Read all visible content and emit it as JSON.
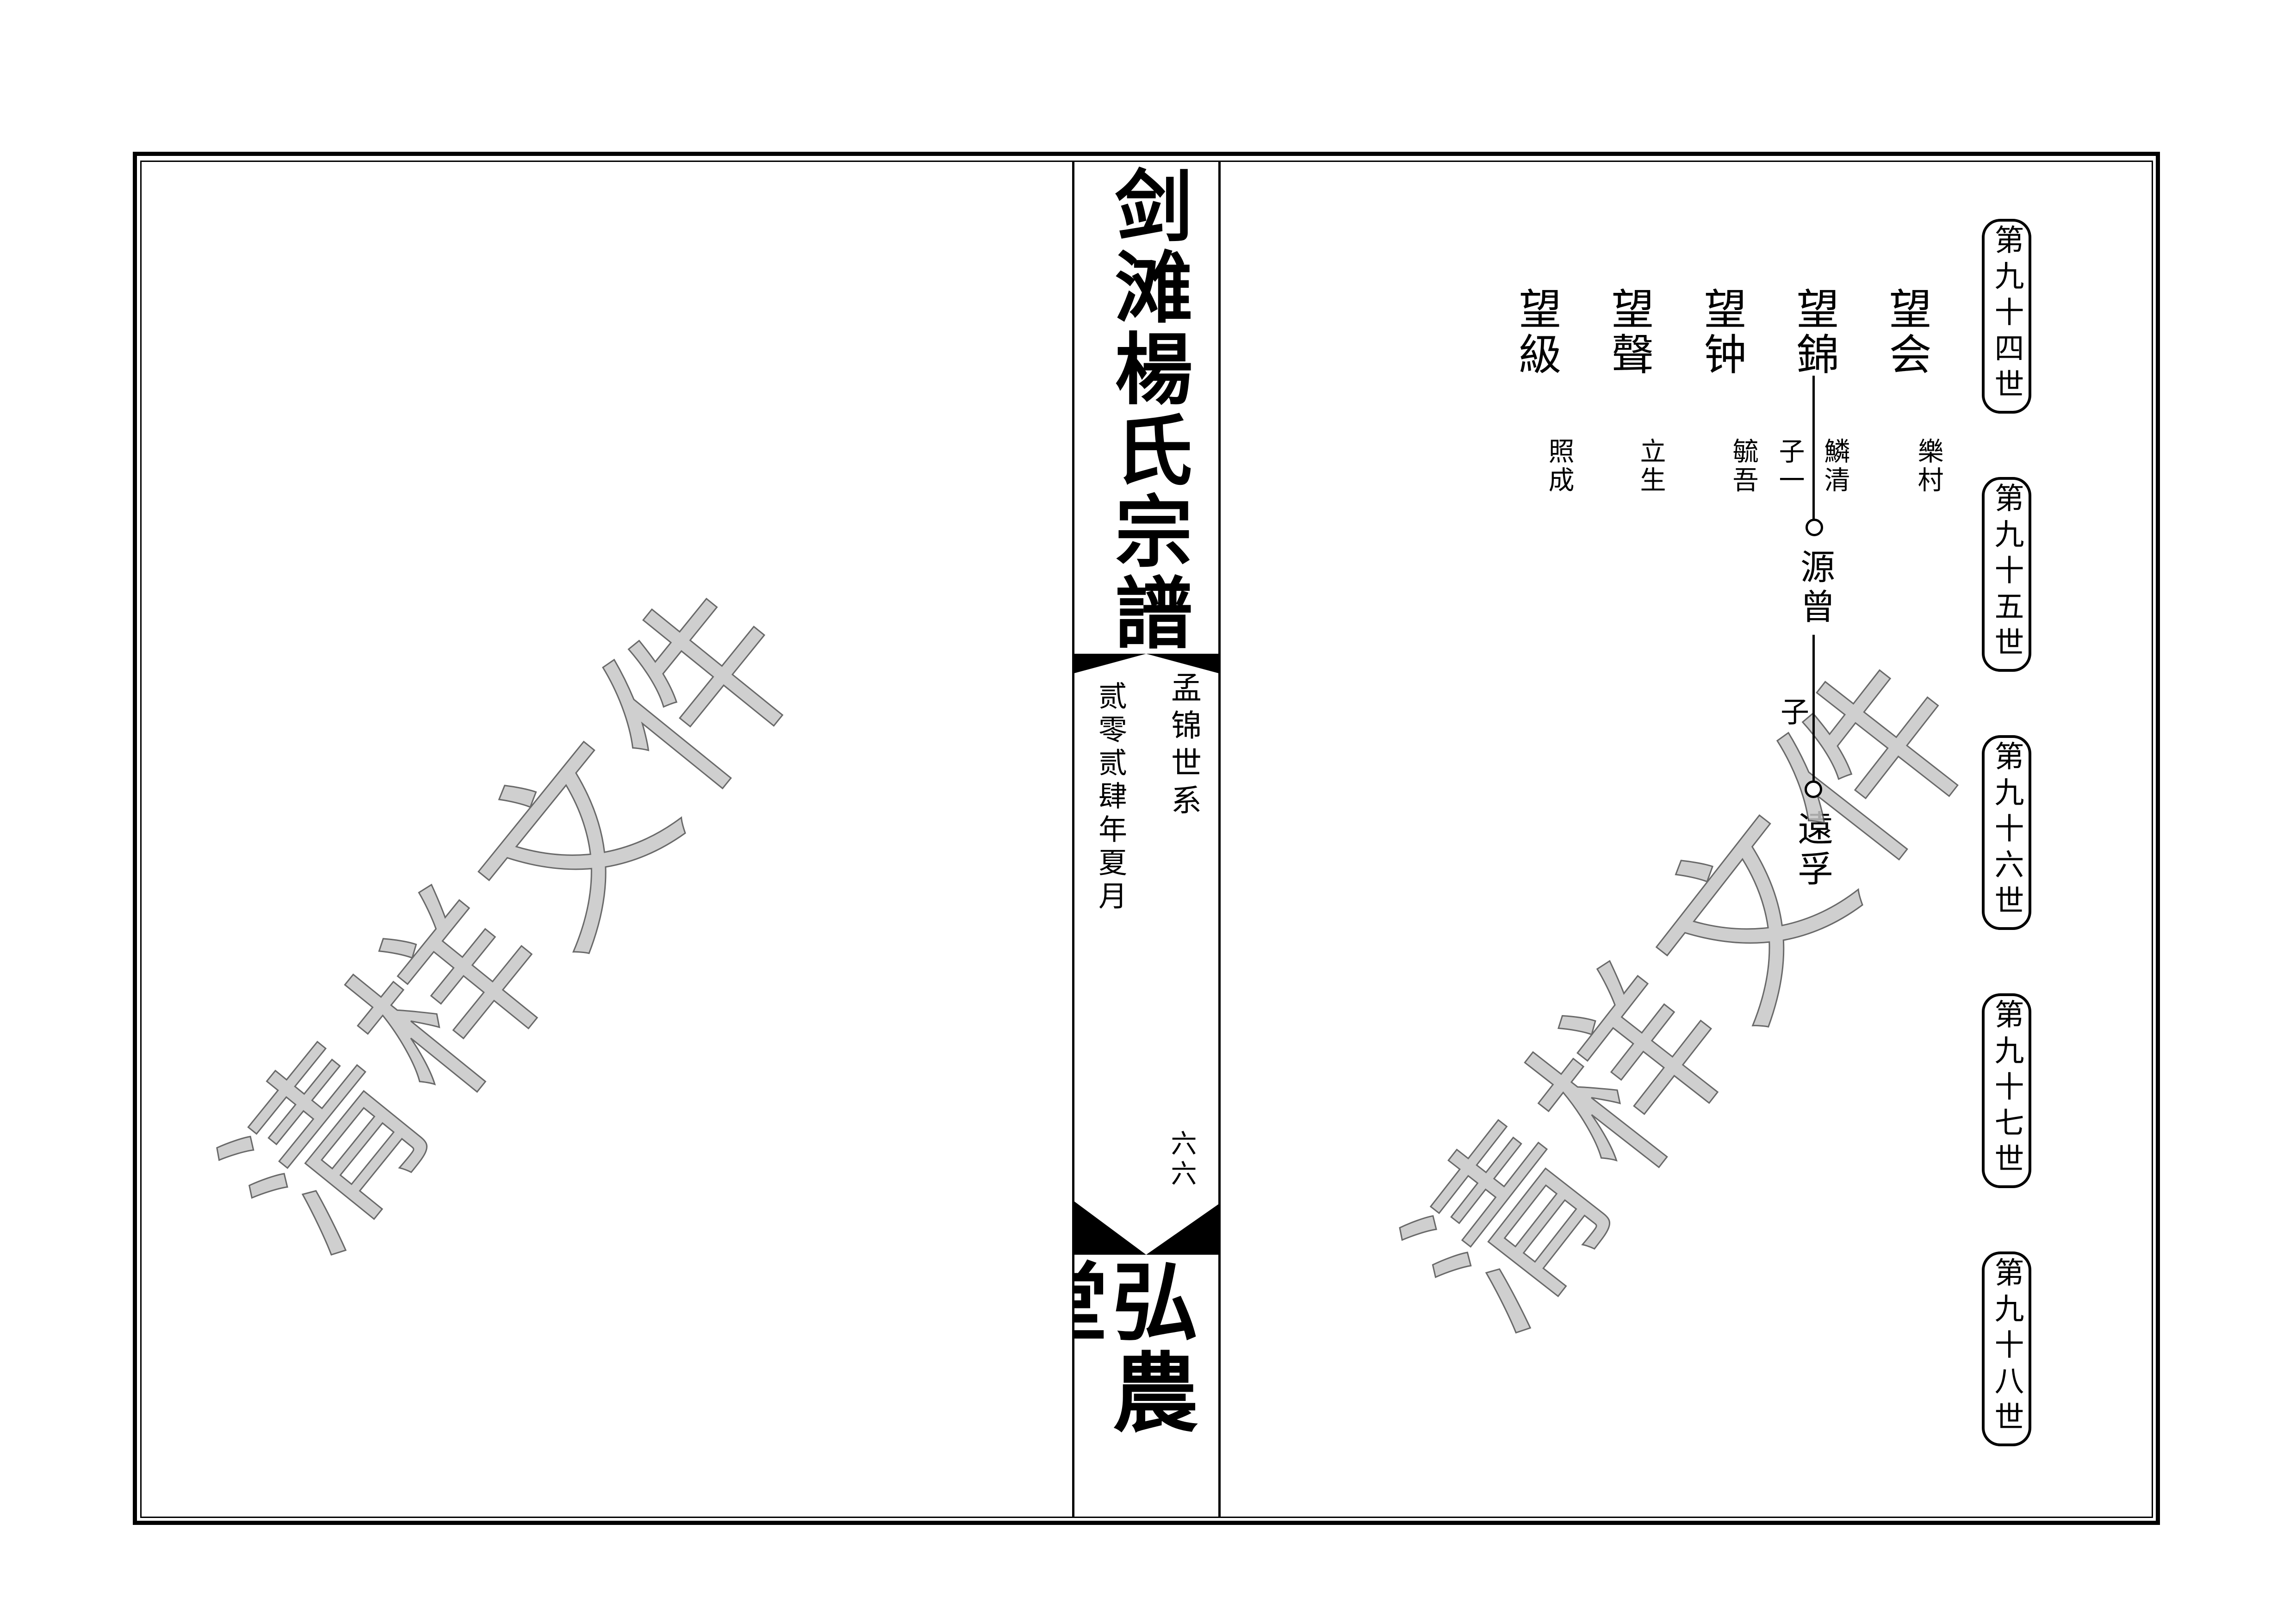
{
  "watermark": {
    "text": "清样文件",
    "fill_color": "#c7c7c7",
    "outline_color": "#4f4f4f"
  },
  "spine": {
    "title": "剑滩楊氏宗譜",
    "lineage_label": "孟锦世系",
    "date_label": "贰零贰肆年夏月",
    "page_number": "六六",
    "hall_name": "弘農堂"
  },
  "right_page": {
    "generation_labels": [
      "第九十四世",
      "第九十五世",
      "第九十六世",
      "第九十七世",
      "第九十八世"
    ],
    "people_gen94": [
      {
        "name": "望会",
        "courtesy_right": "樂村"
      },
      {
        "name": "望錦",
        "courtesy_right": "鱗清",
        "courtesy_left": "子一"
      },
      {
        "name": "望钟",
        "courtesy_right": "毓吾"
      },
      {
        "name": "望聲",
        "courtesy_right": "立生"
      },
      {
        "name": "望級",
        "courtesy_right": "照成"
      }
    ],
    "descendants": [
      {
        "name": "源曾",
        "side_note": "子"
      },
      {
        "name": "遠孚"
      }
    ]
  },
  "colors": {
    "ink": "#000000",
    "paper": "#ffffff"
  }
}
